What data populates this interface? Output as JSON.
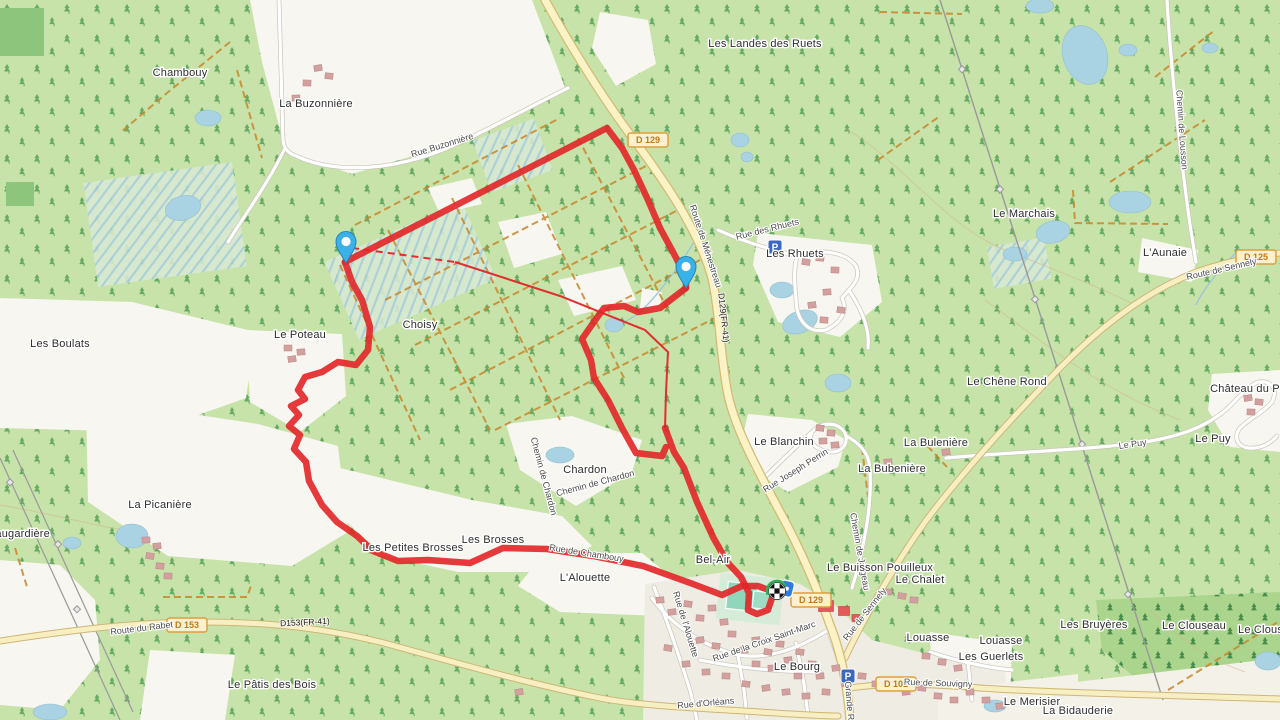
{
  "app": {
    "title": "OpenStreetMap route view"
  },
  "colors": {
    "base_green": "#c7e3a9",
    "dark_green": "#8cc57b",
    "forest_dark": "#abd48c",
    "white_field": "#f8f6f0",
    "town_fill": "#efece3",
    "water": "#a9d2e2",
    "track_orange": "#c8862c",
    "road_yellow": "#f7efc2",
    "road_yellow_casing": "#cdb677",
    "road_cream": "#fbf2c6",
    "road_cream_casing": "#d2ba76",
    "road_white": "#ffffff",
    "road_white_casing": "#c9c5ba",
    "route_red": "#e22528",
    "marker_blue": "#3ab1e8",
    "parking_blue": "#3a66c4",
    "shield_border": "#dd9f3e",
    "shield_fill": "#fdf0cf",
    "pitch_teal": "#8fd6ba",
    "building": "#d3a0a0",
    "building_red": "#e25b5b",
    "power_grey": "#999999",
    "flag_green": "#2fae54"
  },
  "route": {
    "color": "#e22528",
    "width": 6.5,
    "segments": [
      [
        [
          345,
          262
        ],
        [
          352,
          282
        ],
        [
          362,
          300
        ],
        [
          370,
          327
        ],
        [
          368,
          350
        ],
        [
          356,
          365
        ],
        [
          338,
          362
        ],
        [
          322,
          372
        ],
        [
          305,
          377
        ],
        [
          298,
          390
        ],
        [
          305,
          399
        ],
        [
          291,
          406
        ],
        [
          299,
          415
        ],
        [
          289,
          426
        ],
        [
          300,
          435
        ],
        [
          294,
          449
        ],
        [
          306,
          462
        ],
        [
          309,
          481
        ],
        [
          322,
          505
        ],
        [
          337,
          522
        ],
        [
          357,
          536
        ],
        [
          373,
          551
        ],
        [
          398,
          561
        ],
        [
          428,
          560
        ],
        [
          470,
          563
        ],
        [
          503,
          548
        ],
        [
          547,
          549
        ],
        [
          593,
          556
        ],
        [
          643,
          566
        ],
        [
          693,
          584
        ],
        [
          722,
          595
        ],
        [
          742,
          586
        ],
        [
          758,
          586
        ],
        [
          766,
          589
        ]
      ],
      [
        [
          345,
          262
        ],
        [
          607,
          128
        ],
        [
          622,
          148
        ],
        [
          634,
          170
        ],
        [
          648,
          200
        ],
        [
          660,
          228
        ],
        [
          673,
          252
        ],
        [
          686,
          277
        ],
        [
          686,
          288
        ]
      ],
      [
        [
          686,
          288
        ],
        [
          660,
          308
        ],
        [
          638,
          312
        ],
        [
          624,
          306
        ],
        [
          604,
          308
        ],
        [
          596,
          319
        ],
        [
          582,
          339
        ],
        [
          591,
          360
        ],
        [
          594,
          378
        ],
        [
          608,
          400
        ],
        [
          622,
          428
        ],
        [
          636,
          453
        ],
        [
          662,
          456
        ],
        [
          666,
          447
        ]
      ],
      [
        [
          665,
          428
        ],
        [
          674,
          452
        ],
        [
          684,
          468
        ],
        [
          697,
          502
        ],
        [
          713,
          537
        ],
        [
          727,
          562
        ],
        [
          741,
          577
        ],
        [
          749,
          593
        ],
        [
          748,
          610
        ],
        [
          757,
          614
        ],
        [
          768,
          610
        ],
        [
          772,
          598
        ],
        [
          774,
          592
        ]
      ]
    ],
    "thin_solid": [
      [
        455,
        262
      ],
      [
        560,
        296
      ],
      [
        645,
        330
      ],
      [
        668,
        352
      ],
      [
        666,
        392
      ],
      [
        665,
        428
      ]
    ],
    "thin_dashed": [
      [
        352,
        248
      ],
      [
        455,
        262
      ]
    ]
  },
  "markers": {
    "pins": [
      {
        "x": 346,
        "y": 243
      },
      {
        "x": 686,
        "y": 268
      }
    ],
    "finish": {
      "x": 777,
      "y": 591
    },
    "chip": {
      "x": 785,
      "y": 582
    }
  },
  "parking": [
    {
      "x": 775,
      "y": 247
    },
    {
      "x": 848,
      "y": 676
    }
  ],
  "shields": [
    {
      "text": "D 129",
      "x": 648,
      "y": 140
    },
    {
      "text": "D 129",
      "x": 811,
      "y": 600
    },
    {
      "text": "D 153",
      "x": 187,
      "y": 625
    },
    {
      "text": "D 101",
      "x": 896,
      "y": 684
    },
    {
      "text": "D 125",
      "x": 1256,
      "y": 257
    }
  ],
  "road_refs": [
    {
      "text": "D153(FR-41)",
      "x": 305,
      "y": 625,
      "rot": -3
    },
    {
      "text": "D129(FR-41)",
      "x": 721,
      "y": 318,
      "rot": 84
    }
  ],
  "places": [
    {
      "text": "Chambouy",
      "x": 180,
      "y": 76
    },
    {
      "text": "La Buzonnière",
      "x": 316,
      "y": 107
    },
    {
      "text": "Les Landes des Ruets",
      "x": 765,
      "y": 47
    },
    {
      "text": "Le Marchais",
      "x": 1024,
      "y": 217
    },
    {
      "text": "L'Aunaie",
      "x": 1165,
      "y": 256
    },
    {
      "text": "Les Rhuets",
      "x": 795,
      "y": 257
    },
    {
      "text": "Choisy",
      "x": 420,
      "y": 328
    },
    {
      "text": "Le Poteau",
      "x": 300,
      "y": 338
    },
    {
      "text": "Les Boulats",
      "x": 60,
      "y": 347
    },
    {
      "text": "Le Chêne Rond",
      "x": 1007,
      "y": 385
    },
    {
      "text": "Château du Puy",
      "x": 1251,
      "y": 392
    },
    {
      "text": "Le Puy",
      "x": 1213,
      "y": 442
    },
    {
      "text": "Le Blanchin",
      "x": 784,
      "y": 445
    },
    {
      "text": "La Bulenière",
      "x": 936,
      "y": 446
    },
    {
      "text": "La Bubenière",
      "x": 892,
      "y": 472
    },
    {
      "text": "Chardon",
      "x": 585,
      "y": 473
    },
    {
      "text": "La Picanière",
      "x": 160,
      "y": 508
    },
    {
      "text": "Maugardière",
      "x": 18,
      "y": 537
    },
    {
      "text": "Les Petites Brosses",
      "x": 413,
      "y": 551
    },
    {
      "text": "Les Brosses",
      "x": 493,
      "y": 543
    },
    {
      "text": "L'Alouette",
      "x": 585,
      "y": 581
    },
    {
      "text": "Bel-Air",
      "x": 713,
      "y": 563
    },
    {
      "text": "Le Buisson Pouilleux",
      "x": 880,
      "y": 571
    },
    {
      "text": "Le Chalet",
      "x": 920,
      "y": 583
    },
    {
      "text": "Louasse",
      "x": 928,
      "y": 641
    },
    {
      "text": "Louasse",
      "x": 1001,
      "y": 644
    },
    {
      "text": "Les Guerlets",
      "x": 991,
      "y": 660
    },
    {
      "text": "Les Bruyères",
      "x": 1094,
      "y": 628
    },
    {
      "text": "Le Clouseau",
      "x": 1194,
      "y": 629
    },
    {
      "text": "Le Clouseau",
      "x": 1270,
      "y": 633
    },
    {
      "text": "Le Bourg",
      "x": 797,
      "y": 670
    },
    {
      "text": "Le Merisier",
      "x": 1032,
      "y": 705
    },
    {
      "text": "La Bidauderie",
      "x": 1078,
      "y": 714
    },
    {
      "text": "Le Pâtis des Bois",
      "x": 272,
      "y": 688
    }
  ],
  "road_labels": [
    {
      "text": "Rue Buzonnière",
      "x": 443,
      "y": 148,
      "rot": -17
    },
    {
      "text": "Route de Ménestreau",
      "x": 703,
      "y": 247,
      "rot": 72
    },
    {
      "text": "Rue des Rhuets",
      "x": 768,
      "y": 232,
      "rot": -14
    },
    {
      "text": "Chemin de Lousson",
      "x": 1179,
      "y": 130,
      "rot": 86
    },
    {
      "text": "Route de Sennely",
      "x": 1222,
      "y": 272,
      "rot": -13
    },
    {
      "text": "Le Puy",
      "x": 1133,
      "y": 447,
      "rot": -8
    },
    {
      "text": "Rue Joseph Perrin",
      "x": 797,
      "y": 473,
      "rot": -32
    },
    {
      "text": "Chemin de Chardon",
      "x": 541,
      "y": 477,
      "rot": 75
    },
    {
      "text": "Chemin de Chardon",
      "x": 596,
      "y": 486,
      "rot": -15
    },
    {
      "text": "Rue de Chambouy",
      "x": 586,
      "y": 556,
      "rot": 9
    },
    {
      "text": "Rue de l'Alouette",
      "x": 683,
      "y": 625,
      "rot": 73
    },
    {
      "text": "Route du Rabet",
      "x": 142,
      "y": 631,
      "rot": -7
    },
    {
      "text": "Rue de la Croix Saint-Marc",
      "x": 765,
      "y": 644,
      "rot": -19
    },
    {
      "text": "Rue d'Orléans",
      "x": 706,
      "y": 706,
      "rot": -5
    },
    {
      "text": "Grande Rue",
      "x": 847,
      "y": 706,
      "rot": 85
    },
    {
      "text": "Rue de Souvigny",
      "x": 938,
      "y": 686,
      "rot": 2
    },
    {
      "text": "Rue de Sennely",
      "x": 867,
      "y": 616,
      "rot": -52
    },
    {
      "text": "Chemin de Jargeau",
      "x": 857,
      "y": 552,
      "rot": 80
    }
  ],
  "buildings": {
    "normal_color": "#d3a0a0",
    "stroke": "#b98484",
    "red_color": "#e25b5b",
    "items": [
      [
        318,
        68
      ],
      [
        329,
        76
      ],
      [
        307,
        83
      ],
      [
        296,
        98
      ],
      [
        306,
        104
      ],
      [
        806,
        262
      ],
      [
        820,
        258
      ],
      [
        835,
        270
      ],
      [
        827,
        292
      ],
      [
        812,
        305
      ],
      [
        841,
        310
      ],
      [
        824,
        320
      ],
      [
        288,
        348
      ],
      [
        301,
        352
      ],
      [
        292,
        359
      ],
      [
        820,
        428
      ],
      [
        831,
        433
      ],
      [
        823,
        441
      ],
      [
        835,
        445
      ],
      [
        1248,
        398
      ],
      [
        1259,
        402
      ],
      [
        1251,
        412
      ],
      [
        146,
        540
      ],
      [
        157,
        546
      ],
      [
        150,
        556
      ],
      [
        160,
        566
      ],
      [
        168,
        576
      ],
      [
        888,
        462
      ],
      [
        946,
        452
      ],
      [
        902,
        596
      ],
      [
        914,
        600
      ],
      [
        888,
        592
      ],
      [
        660,
        600
      ],
      [
        672,
        612
      ],
      [
        688,
        604
      ],
      [
        700,
        618
      ],
      [
        712,
        608
      ],
      [
        724,
        622
      ],
      [
        700,
        640
      ],
      [
        716,
        646
      ],
      [
        732,
        634
      ],
      [
        744,
        650
      ],
      [
        756,
        640
      ],
      [
        768,
        652
      ],
      [
        780,
        644
      ],
      [
        756,
        664
      ],
      [
        772,
        668
      ],
      [
        788,
        660
      ],
      [
        800,
        652
      ],
      [
        812,
        664
      ],
      [
        798,
        676
      ],
      [
        820,
        676
      ],
      [
        836,
        668
      ],
      [
        846,
        684
      ],
      [
        826,
        692
      ],
      [
        806,
        696
      ],
      [
        786,
        692
      ],
      [
        766,
        688
      ],
      [
        746,
        684
      ],
      [
        726,
        676
      ],
      [
        706,
        672
      ],
      [
        686,
        664
      ],
      [
        668,
        648
      ],
      [
        862,
        676
      ],
      [
        876,
        684
      ],
      [
        890,
        688
      ],
      [
        906,
        692
      ],
      [
        922,
        688
      ],
      [
        938,
        696
      ],
      [
        954,
        700
      ],
      [
        970,
        692
      ],
      [
        958,
        668
      ],
      [
        942,
        662
      ],
      [
        926,
        656
      ],
      [
        986,
        700
      ],
      [
        1000,
        706
      ],
      [
        519,
        692
      ]
    ],
    "red_items": [
      [
        826,
        606,
        15,
        11
      ],
      [
        844,
        611,
        11,
        9
      ],
      [
        856,
        618,
        8,
        7
      ]
    ]
  }
}
